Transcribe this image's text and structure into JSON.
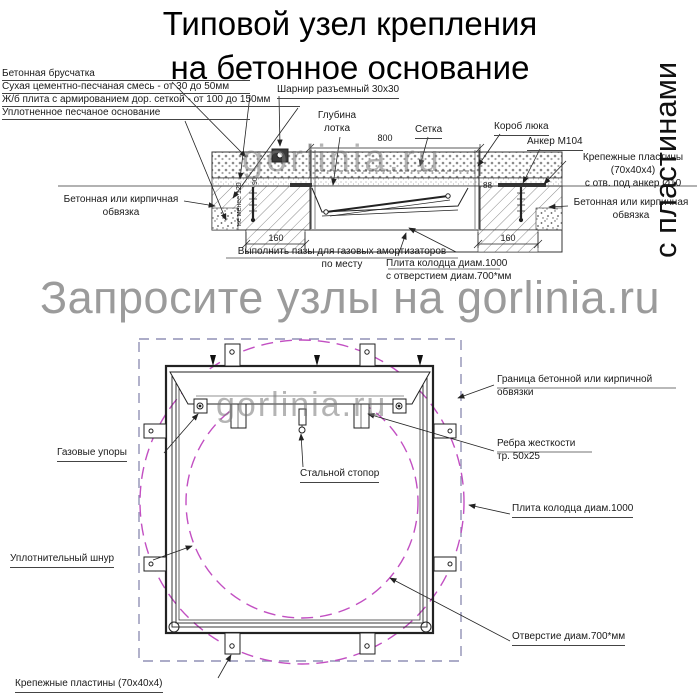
{
  "title": "Типовой узел крепления\nна бетонное основание",
  "side_note": "с пластинами",
  "watermark": {
    "section": "gorlinia.ru",
    "banner": "Запросите узлы на gorlinia.ru",
    "plan": "gorlinia.ru"
  },
  "section": {
    "labels": {
      "paving": "Бетонная брусчатка",
      "dry_mix": "Сухая цементно-песчаная смесь - от 30 до 50мм",
      "rc_slab": "Ж/б плита с армированием дор. сеткой - от 100 до 150мм",
      "sand_base": "Уплотненное песчаное основание",
      "hinge": "Шарнир разъемный 30x30",
      "tray_depth": "Глубина\nлотка",
      "mesh": "Сетка",
      "hatch_box": "Короб люка",
      "anchor": "Анкер М104",
      "plates": "Крепежные пластины (70x40x4)\nс отв. под анкер Ø10",
      "edging_left": "Бетонная или кирпичная\nобвязка",
      "edging_right": "Бетонная или кирпичная\nобвязка",
      "grooves": "Выполнить пазы для газовых амортизаторов\nпо месту",
      "slab_hole": "Плита колодца диам.1000\nс отверстием диам.700*мм"
    },
    "dimensions": {
      "span": "800",
      "left_pier": "160",
      "right_pier": "160",
      "lip": "88",
      "depth_min": "не менее 120",
      "side": "90"
    }
  },
  "plan": {
    "labels": {
      "boundary": "Граница бетонной или кирпичной\nобвязки",
      "ribs": "Ребра жесткости\nтр. 50x25",
      "slab": "Плита колодца диам.1000",
      "hole": "Отверстие диам.700*мм",
      "plates": "Крепежные пластины (70x40x4)",
      "gas_struts": "Газовые упоры",
      "stopper": "Стальной стопор",
      "cord": "Уплотнительный шнур"
    }
  },
  "colors": {
    "line": "#1a1a1a",
    "circle_dashed": "#c24fc2",
    "boundary_dashed": "#9191b5",
    "watermark": "#9b9b9b"
  }
}
